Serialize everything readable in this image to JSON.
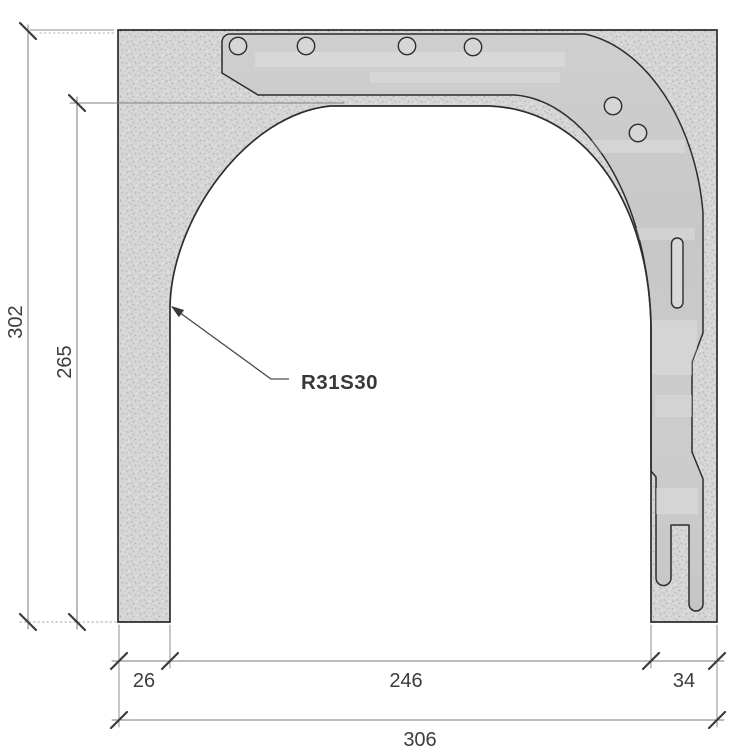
{
  "drawing": {
    "leader_label": "R31S30",
    "dimensions": {
      "total_height": "302",
      "inner_height": "265",
      "left_wall_width": "26",
      "opening_width": "246",
      "right_wall_width": "34",
      "total_width": "306"
    },
    "colors": {
      "concrete_base": "#d7d7d7",
      "plate_gray": "#cbcbcb",
      "outline": "#2d2d2d",
      "dimension_line": "#7a7a7a",
      "dimension_text": "#3d3d3d"
    }
  }
}
